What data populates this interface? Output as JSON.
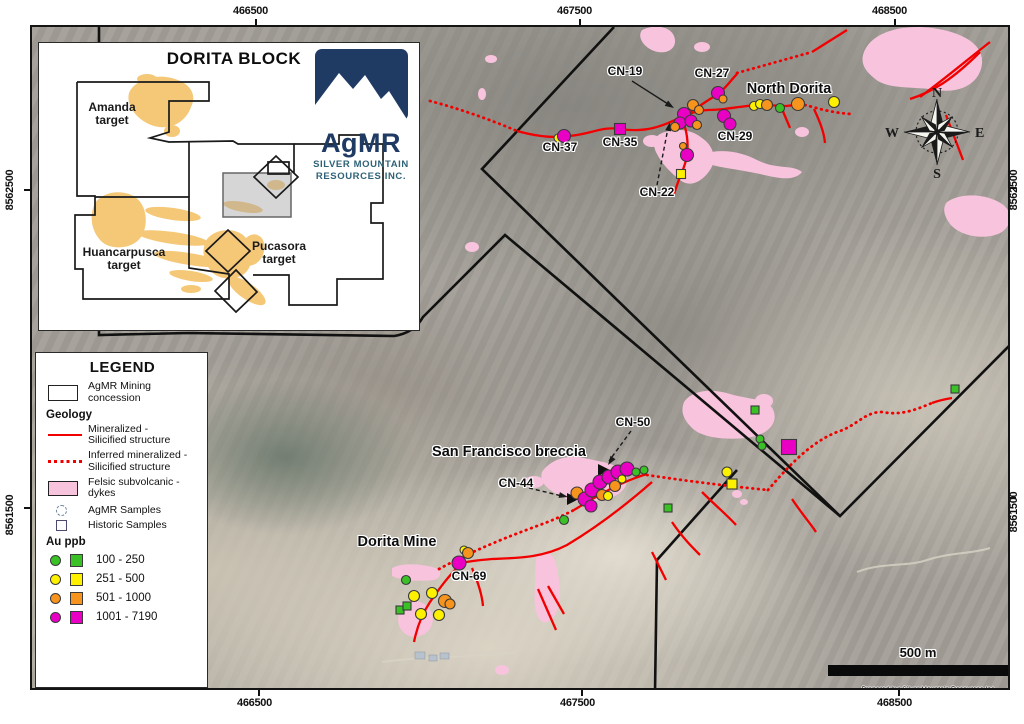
{
  "frame": {
    "coords_top": [
      "466500",
      "467500",
      "468500"
    ],
    "coords_bottom": [
      "466500",
      "467500",
      "468500"
    ],
    "coords_left": [
      "8562500",
      "8561500"
    ],
    "coords_right": [
      "8562500",
      "8561500"
    ]
  },
  "inset": {
    "title": "DORITA BLOCK",
    "targets": [
      {
        "id": "amanda",
        "label": "Amanda\ntarget",
        "x": 28,
        "y": 58,
        "w": 90
      },
      {
        "id": "huancarpusca",
        "label": "Huancarpusca\ntarget",
        "x": 30,
        "y": 203,
        "w": 110
      },
      {
        "id": "pucasora",
        "label": "Pucasora\ntarget",
        "x": 195,
        "y": 197,
        "w": 90
      }
    ],
    "logo": {
      "brand": "AgMR",
      "company_line1": "SILVER MOUNTAIN",
      "company_line2": "RESOURCES INC."
    }
  },
  "legend": {
    "title": "LEGEND",
    "concession_label": "AgMR Mining\nconcession",
    "geology_header": "Geology",
    "mineralized_label": "Mineralized -\nSilicified structure",
    "inferred_label": "Inferred mineralized -\nSilicified structure",
    "felsic_label": "Felsic subvolcanic -\ndykes",
    "agmr_samples_label": "AgMR Samples",
    "historic_samples_label": "Historic Samples",
    "au_header": "Au ppb",
    "au_buckets": [
      {
        "range": "100 - 250",
        "color": "#39C126"
      },
      {
        "range": "251 - 500",
        "color": "#FDF100"
      },
      {
        "range": "501 - 1000",
        "color": "#F7941E"
      },
      {
        "range": "1001 - 7190",
        "color": "#EA00C4"
      }
    ]
  },
  "compass": {
    "n": "N",
    "e": "E",
    "s": "S",
    "w": "W"
  },
  "scale_bar": {
    "label": "500 m"
  },
  "credits": {
    "line1": "Prepared by: Silver Mountain Resources Inc",
    "line2": "Datum: WGS84 Zone 18 South"
  },
  "map_labels": [
    {
      "id": "north-dorita",
      "text": "North Dorita",
      "x": 789,
      "y": 81,
      "k": "area"
    },
    {
      "id": "san-francisco-breccia",
      "text": "San Francisco breccia",
      "x": 509,
      "y": 444,
      "k": "area"
    },
    {
      "id": "dorita-mine",
      "text": "Dorita Mine",
      "x": 397,
      "y": 534,
      "k": "area"
    },
    {
      "id": "cn-19",
      "text": "CN-19",
      "x": 625,
      "y": 64,
      "k": "cn"
    },
    {
      "id": "cn-27",
      "text": "CN-27",
      "x": 712,
      "y": 66,
      "k": "cn"
    },
    {
      "id": "cn-37",
      "text": "CN-37",
      "x": 560,
      "y": 140,
      "k": "cn"
    },
    {
      "id": "cn-35",
      "text": "CN-35",
      "x": 620,
      "y": 135,
      "k": "cn"
    },
    {
      "id": "cn-29",
      "text": "CN-29",
      "x": 735,
      "y": 129,
      "k": "cn"
    },
    {
      "id": "cn-22",
      "text": "CN-22",
      "x": 657,
      "y": 185,
      "k": "cn"
    },
    {
      "id": "cn-50",
      "text": "CN-50",
      "x": 633,
      "y": 415,
      "k": "cn"
    },
    {
      "id": "cn-44",
      "text": "CN-44",
      "x": 516,
      "y": 476,
      "k": "cn"
    },
    {
      "id": "cn-69",
      "text": "CN-69",
      "x": 469,
      "y": 569,
      "k": "cn"
    }
  ],
  "au_colors": {
    "green": "#39C126",
    "yellow": "#FDF100",
    "orange": "#F7941E",
    "magenta": "#EA00C4"
  },
  "samples": [
    {
      "x": 556,
      "y": 136,
      "b": "yellow",
      "t": "circle",
      "r": 4
    },
    {
      "x": 562,
      "y": 134,
      "b": "magenta",
      "t": "circle",
      "r": 6.5
    },
    {
      "x": 618,
      "y": 127,
      "b": "magenta",
      "t": "square",
      "r": 5.5
    },
    {
      "x": 691,
      "y": 103,
      "b": "orange",
      "t": "circle",
      "r": 5.5
    },
    {
      "x": 697,
      "y": 108,
      "b": "orange",
      "t": "circle",
      "r": 4.5
    },
    {
      "x": 682,
      "y": 112,
      "b": "magenta",
      "t": "circle",
      "r": 6.5
    },
    {
      "x": 678,
      "y": 121,
      "b": "magenta",
      "t": "circle",
      "r": 6
    },
    {
      "x": 689,
      "y": 119,
      "b": "magenta",
      "t": "circle",
      "r": 6
    },
    {
      "x": 695,
      "y": 123,
      "b": "orange",
      "t": "circle",
      "r": 4.5
    },
    {
      "x": 673,
      "y": 125,
      "b": "orange",
      "t": "circle",
      "r": 4.5
    },
    {
      "x": 681,
      "y": 144,
      "b": "orange",
      "t": "circle",
      "r": 3.5
    },
    {
      "x": 685,
      "y": 153,
      "b": "magenta",
      "t": "circle",
      "r": 6.5
    },
    {
      "x": 679,
      "y": 172,
      "b": "yellow",
      "t": "square",
      "r": 4.5
    },
    {
      "x": 716,
      "y": 91,
      "b": "magenta",
      "t": "circle",
      "r": 6.5
    },
    {
      "x": 721,
      "y": 97,
      "b": "orange",
      "t": "circle",
      "r": 4
    },
    {
      "x": 722,
      "y": 114,
      "b": "magenta",
      "t": "circle",
      "r": 6.5
    },
    {
      "x": 728,
      "y": 122,
      "b": "magenta",
      "t": "circle",
      "r": 6
    },
    {
      "x": 752,
      "y": 104,
      "b": "yellow",
      "t": "circle",
      "r": 4.5
    },
    {
      "x": 758,
      "y": 102,
      "b": "yellow",
      "t": "circle",
      "r": 4.5
    },
    {
      "x": 765,
      "y": 103,
      "b": "orange",
      "t": "circle",
      "r": 5.5
    },
    {
      "x": 778,
      "y": 106,
      "b": "green",
      "t": "circle",
      "r": 4.5
    },
    {
      "x": 796,
      "y": 102,
      "b": "orange",
      "t": "circle",
      "r": 6.5
    },
    {
      "x": 832,
      "y": 100,
      "b": "yellow",
      "t": "circle",
      "r": 5.5
    },
    {
      "x": 575,
      "y": 491,
      "b": "orange",
      "t": "circle",
      "r": 6
    },
    {
      "x": 583,
      "y": 497,
      "b": "magenta",
      "t": "circle",
      "r": 7
    },
    {
      "x": 590,
      "y": 488,
      "b": "magenta",
      "t": "circle",
      "r": 7
    },
    {
      "x": 600,
      "y": 493,
      "b": "orange",
      "t": "circle",
      "r": 5.5
    },
    {
      "x": 598,
      "y": 480,
      "b": "magenta",
      "t": "circle",
      "r": 7
    },
    {
      "x": 606,
      "y": 494,
      "b": "yellow",
      "t": "circle",
      "r": 4.5
    },
    {
      "x": 607,
      "y": 475,
      "b": "magenta",
      "t": "circle",
      "r": 7
    },
    {
      "x": 613,
      "y": 484,
      "b": "orange",
      "t": "circle",
      "r": 5.5
    },
    {
      "x": 616,
      "y": 470,
      "b": "magenta",
      "t": "circle",
      "r": 7
    },
    {
      "x": 625,
      "y": 467,
      "b": "magenta",
      "t": "circle",
      "r": 7
    },
    {
      "x": 620,
      "y": 477,
      "b": "yellow",
      "t": "circle",
      "r": 4
    },
    {
      "x": 634,
      "y": 470,
      "b": "green",
      "t": "circle",
      "r": 4
    },
    {
      "x": 642,
      "y": 468,
      "b": "green",
      "t": "circle",
      "r": 4
    },
    {
      "x": 589,
      "y": 504,
      "b": "magenta",
      "t": "circle",
      "r": 6
    },
    {
      "x": 562,
      "y": 518,
      "b": "green",
      "t": "circle",
      "r": 4.5
    },
    {
      "x": 666,
      "y": 506,
      "b": "green",
      "t": "square",
      "r": 4
    },
    {
      "x": 753,
      "y": 408,
      "b": "green",
      "t": "square",
      "r": 4
    },
    {
      "x": 758,
      "y": 437,
      "b": "green",
      "t": "circle",
      "r": 4
    },
    {
      "x": 760,
      "y": 444,
      "b": "green",
      "t": "circle",
      "r": 4
    },
    {
      "x": 725,
      "y": 470,
      "b": "yellow",
      "t": "circle",
      "r": 5
    },
    {
      "x": 730,
      "y": 482,
      "b": "yellow",
      "t": "square",
      "r": 5
    },
    {
      "x": 787,
      "y": 445,
      "b": "magenta",
      "t": "square",
      "r": 7.5
    },
    {
      "x": 953,
      "y": 387,
      "b": "green",
      "t": "square",
      "r": 4
    },
    {
      "x": 462,
      "y": 548,
      "b": "yellow",
      "t": "circle",
      "r": 4
    },
    {
      "x": 466,
      "y": 551,
      "b": "orange",
      "t": "circle",
      "r": 5.5
    },
    {
      "x": 457,
      "y": 561,
      "b": "magenta",
      "t": "circle",
      "r": 7
    },
    {
      "x": 404,
      "y": 578,
      "b": "green",
      "t": "circle",
      "r": 4.5
    },
    {
      "x": 412,
      "y": 594,
      "b": "yellow",
      "t": "circle",
      "r": 5.5
    },
    {
      "x": 430,
      "y": 591,
      "b": "yellow",
      "t": "circle",
      "r": 5.5
    },
    {
      "x": 419,
      "y": 612,
      "b": "yellow",
      "t": "circle",
      "r": 5.5
    },
    {
      "x": 437,
      "y": 613,
      "b": "yellow",
      "t": "circle",
      "r": 5.5
    },
    {
      "x": 443,
      "y": 599,
      "b": "orange",
      "t": "circle",
      "r": 6.5
    },
    {
      "x": 448,
      "y": 602,
      "b": "orange",
      "t": "circle",
      "r": 5
    },
    {
      "x": 398,
      "y": 608,
      "b": "green",
      "t": "square",
      "r": 4
    },
    {
      "x": 405,
      "y": 604,
      "b": "green",
      "t": "square",
      "r": 4
    }
  ]
}
